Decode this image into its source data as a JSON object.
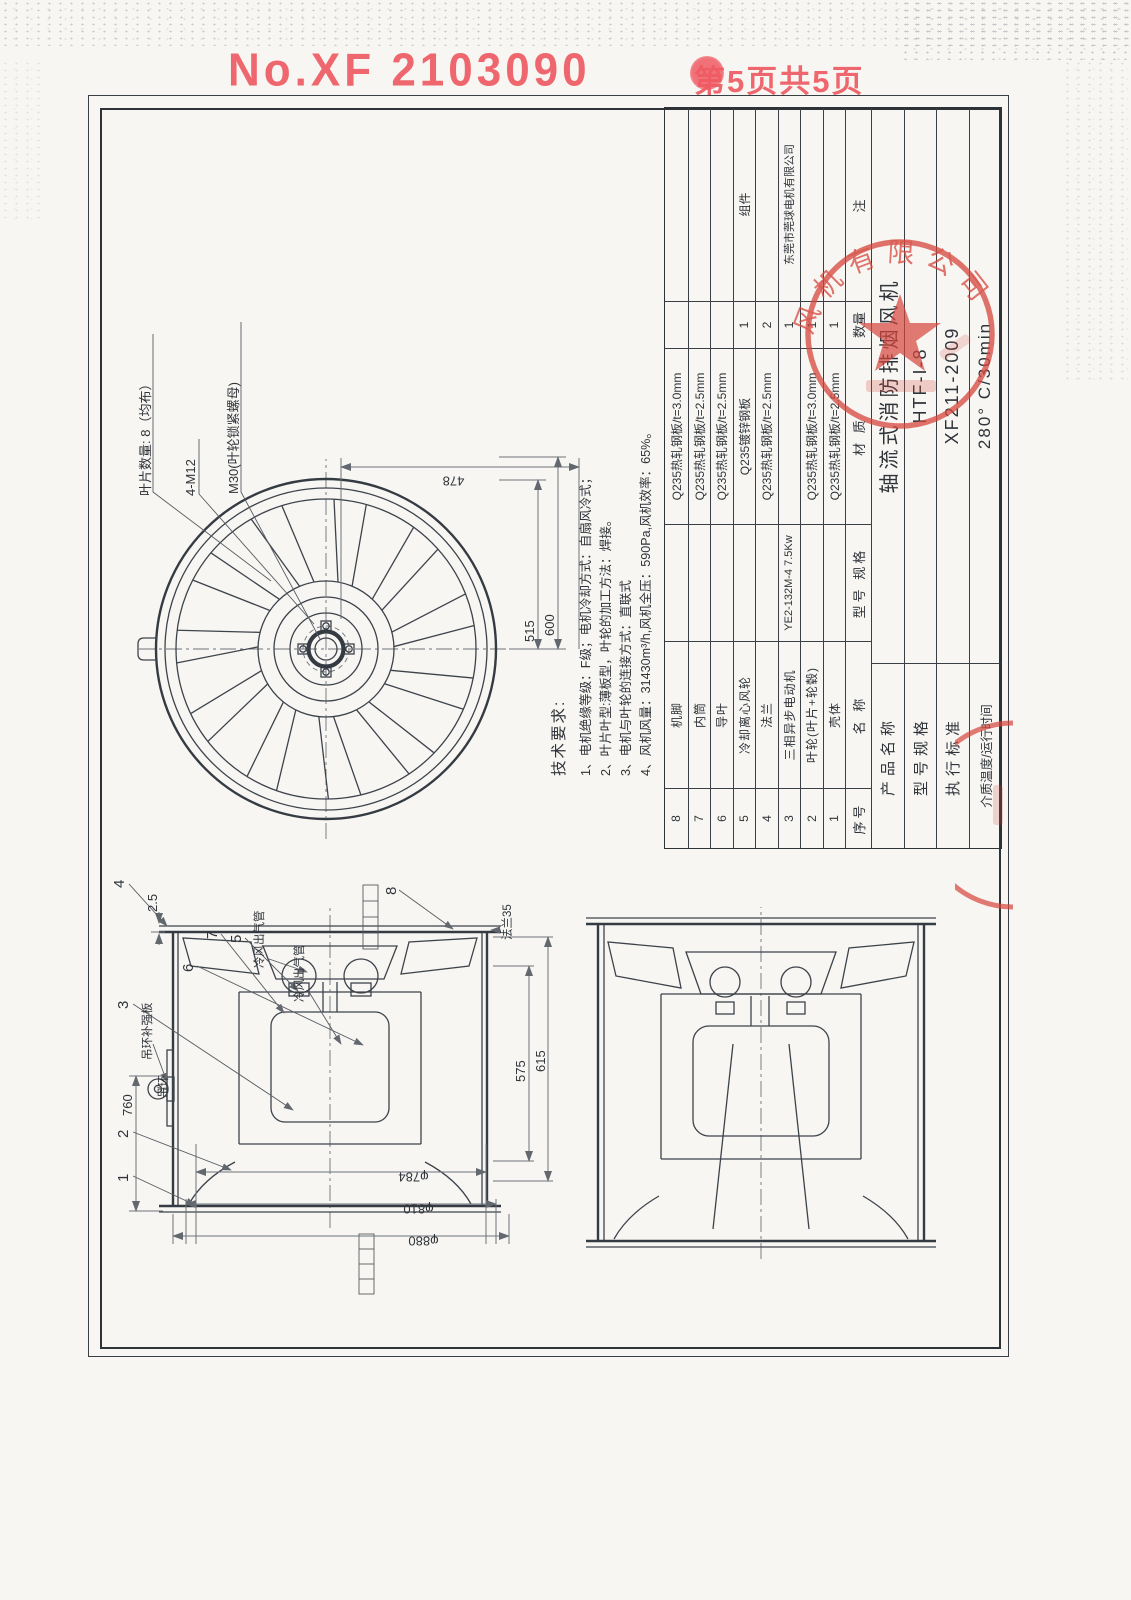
{
  "header": {
    "doc_no": "No.XF 2103090",
    "page_label": "第5页共5页"
  },
  "fan_view": {
    "blade_count_label": "叶片数量: 8（均布）",
    "bolt_label": "4-M12",
    "nut_label": "M30(叶轮锁紧螺母)",
    "dim_478": "478",
    "dim_515": "515",
    "dim_600": "600"
  },
  "side_view": {
    "callouts": [
      "1",
      "2",
      "3",
      "4",
      "5",
      "6",
      "7",
      "8"
    ],
    "eyebolt_label": "吊环",
    "eyebolt_plate_label": "吊环补强板",
    "cold_air_pipe_label_1": "冷风出气管",
    "cold_air_pipe_label_2": "冷风出气管",
    "flange_label": "法兰35",
    "dim_2_5": "2.5",
    "dim_760": "760",
    "dim_575": "575",
    "dim_615": "615",
    "dia_784": "φ784",
    "dia_810": "φ810",
    "dia_880": "φ880"
  },
  "tech_requirements": {
    "title": "技术要求:",
    "item1": "1、电机绝缘等级：F级；电机冷却方式：自扇风冷式；",
    "item2": "2、叶片叶型:薄板型，叶轮的加工方法：焊接。",
    "item3": "3、电机与叶轮的连接方式：直联式",
    "item4": "4、风机风量：31430m³/h,风机全压：590Pa,风机效率：65%。"
  },
  "parts_table": {
    "headers": {
      "no": "序号",
      "name": "名  称",
      "spec": "型号 规格",
      "material": "材  质",
      "qty": "数量",
      "note": "注"
    },
    "rows": [
      {
        "no": "8",
        "name": "机脚",
        "spec": "",
        "material": "Q235热轧钢板/t=3.0mm",
        "qty": "",
        "note": ""
      },
      {
        "no": "7",
        "name": "内筒",
        "spec": "",
        "material": "Q235热轧钢板/t=2.5mm",
        "qty": "",
        "note": ""
      },
      {
        "no": "6",
        "name": "导叶",
        "spec": "",
        "material": "Q235热轧钢板/t=2.5mm",
        "qty": "",
        "note": ""
      },
      {
        "no": "5",
        "name": "冷却离心风轮",
        "spec": "",
        "material": "Q235镀锌钢板",
        "qty": "1",
        "note": "组件"
      },
      {
        "no": "4",
        "name": "法兰",
        "spec": "",
        "material": "Q235热轧钢板/t=2.5mm",
        "qty": "2",
        "note": ""
      },
      {
        "no": "3",
        "name": "三相异步电动机",
        "spec": "YE2-132M-4 7.5Kw",
        "material": "",
        "qty": "1",
        "note": "东莞市莞球电机有限公司"
      },
      {
        "no": "2",
        "name": "叶轮(叶片+轮毂)",
        "spec": "",
        "material": "Q235热轧钢板/t=3.0mm",
        "qty": "1",
        "note": ""
      },
      {
        "no": "1",
        "name": "壳体",
        "spec": "",
        "material": "Q235热轧钢板/t=2.5mm",
        "qty": "1",
        "note": ""
      }
    ]
  },
  "title_block": {
    "rows": [
      {
        "label": "产品名称",
        "value": "轴流式消防排烟风机"
      },
      {
        "label": "型号规格",
        "value": "HTF-I-8"
      },
      {
        "label": "执行标准",
        "value": "XF211-2009"
      },
      {
        "label": "介质温度/运行时间",
        "value": "280° C/30min"
      }
    ]
  },
  "seal": {
    "visible_text": "风机有限公司",
    "color": "#d6453c"
  },
  "colors": {
    "stamp_red": "#ef5b63",
    "line": "#3d434b",
    "paper": "#f7f6f2"
  }
}
